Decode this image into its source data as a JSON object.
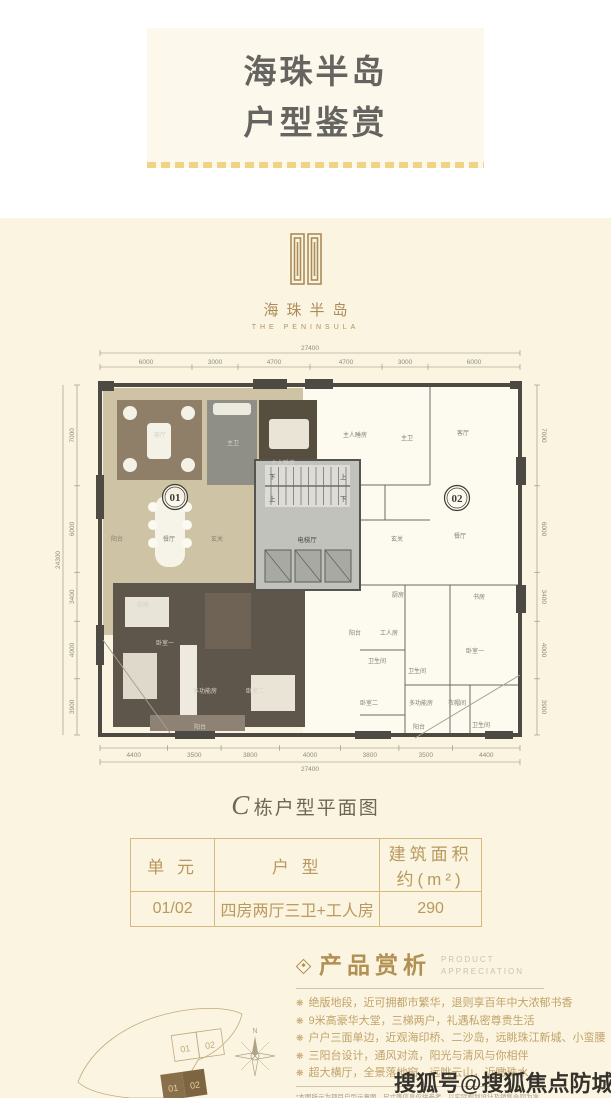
{
  "header": {
    "title_line1": "海珠半岛",
    "title_line2": "户型鉴赏"
  },
  "logo": {
    "name_cn": "海珠半岛",
    "name_en": "THE PENINSULA"
  },
  "floorplan": {
    "total_width": "27400",
    "total_height": "24300",
    "dims_top": [
      "6000",
      "3000",
      "4700",
      "4700",
      "3000",
      "6000"
    ],
    "dims_bottom": [
      "4400",
      "3500",
      "3800",
      "4000",
      "3800",
      "3500",
      "4400"
    ],
    "dims_left": [
      "7000",
      "6000",
      "3400",
      "4000",
      "3900"
    ],
    "dims_right": [
      "7000",
      "6000",
      "3400",
      "4000",
      "3900"
    ],
    "unit_badges": [
      "01",
      "02"
    ],
    "core_label": "电梯厅",
    "stair_up": "上",
    "stair_down": "下",
    "rooms": [
      {
        "label": "客厅",
        "x": 105,
        "y": 92,
        "tone": "light"
      },
      {
        "label": "主卫",
        "x": 178,
        "y": 100,
        "tone": "light"
      },
      {
        "label": "主人睡房",
        "x": 228,
        "y": 120,
        "tone": "light"
      },
      {
        "label": "餐厅",
        "x": 114,
        "y": 196,
        "tone": "dark"
      },
      {
        "label": "阳台",
        "x": 62,
        "y": 196,
        "tone": "dark"
      },
      {
        "label": "玄关",
        "x": 162,
        "y": 196,
        "tone": "dark"
      },
      {
        "label": "厨房",
        "x": 88,
        "y": 262,
        "tone": "light"
      },
      {
        "label": "卧室一",
        "x": 110,
        "y": 300,
        "tone": "light"
      },
      {
        "label": "多功能房",
        "x": 150,
        "y": 348,
        "tone": "light"
      },
      {
        "label": "卧室二",
        "x": 200,
        "y": 348,
        "tone": "light"
      },
      {
        "label": "阳台",
        "x": 145,
        "y": 384,
        "tone": "light"
      },
      {
        "label": "主人睡房",
        "x": 300,
        "y": 92,
        "tone": "dark"
      },
      {
        "label": "主卫",
        "x": 352,
        "y": 95,
        "tone": "dark"
      },
      {
        "label": "客厅",
        "x": 408,
        "y": 90,
        "tone": "dark"
      },
      {
        "label": "餐厅",
        "x": 405,
        "y": 193,
        "tone": "dark"
      },
      {
        "label": "玄关",
        "x": 342,
        "y": 196,
        "tone": "dark"
      },
      {
        "label": "厨房",
        "x": 343,
        "y": 252,
        "tone": "dark"
      },
      {
        "label": "书房",
        "x": 424,
        "y": 254,
        "tone": "dark"
      },
      {
        "label": "阳台",
        "x": 300,
        "y": 290,
        "tone": "dark"
      },
      {
        "label": "工人房",
        "x": 334,
        "y": 290,
        "tone": "dark"
      },
      {
        "label": "卫生间",
        "x": 322,
        "y": 318,
        "tone": "dark"
      },
      {
        "label": "卫生间",
        "x": 362,
        "y": 328,
        "tone": "dark"
      },
      {
        "label": "卧室一",
        "x": 420,
        "y": 308,
        "tone": "dark"
      },
      {
        "label": "卧室二",
        "x": 314,
        "y": 360,
        "tone": "dark"
      },
      {
        "label": "多功能房",
        "x": 366,
        "y": 360,
        "tone": "dark"
      },
      {
        "label": "衣帽间",
        "x": 402,
        "y": 360,
        "tone": "dark"
      },
      {
        "label": "卫生间",
        "x": 426,
        "y": 382,
        "tone": "dark"
      },
      {
        "label": "阳台",
        "x": 364,
        "y": 384,
        "tone": "dark"
      }
    ]
  },
  "caption": {
    "building": "C",
    "text": "栋户型平面图"
  },
  "table": {
    "headers": [
      "单  元",
      "户  型",
      "建筑面积约(m²)"
    ],
    "row": {
      "unit": "01/02",
      "layout": "四房两厅三卫+工人房",
      "area": "290"
    }
  },
  "features": {
    "title": "产品赏析",
    "subtitle_line1": "PRODUCT",
    "subtitle_line2": "APPRECIATION",
    "bullet_icon": "❋",
    "items": [
      "绝版地段，近可拥都市繁华，退则享百年中大浓郁书香",
      "9米高豪华大堂，三梯两户，礼遇私密尊贵生活",
      "户户三面单边，近观海印桥、二沙岛，远眺珠江新城、小蛮腰",
      "三阳台设计，通风对流，阳光与清风与你相伴",
      "超大横厅，全景落地窗，远眺云山，近瞰珠水"
    ],
    "disclaimer": "*本图所示为项目户型示意图，尺寸等信息仅供参考，以实际规划设计及销售合同为准"
  },
  "siteplan": {
    "cell_left": "01",
    "cell_right": "02",
    "compass_label": "N"
  },
  "watermark": "搜狐号@搜狐焦点防城港站"
}
